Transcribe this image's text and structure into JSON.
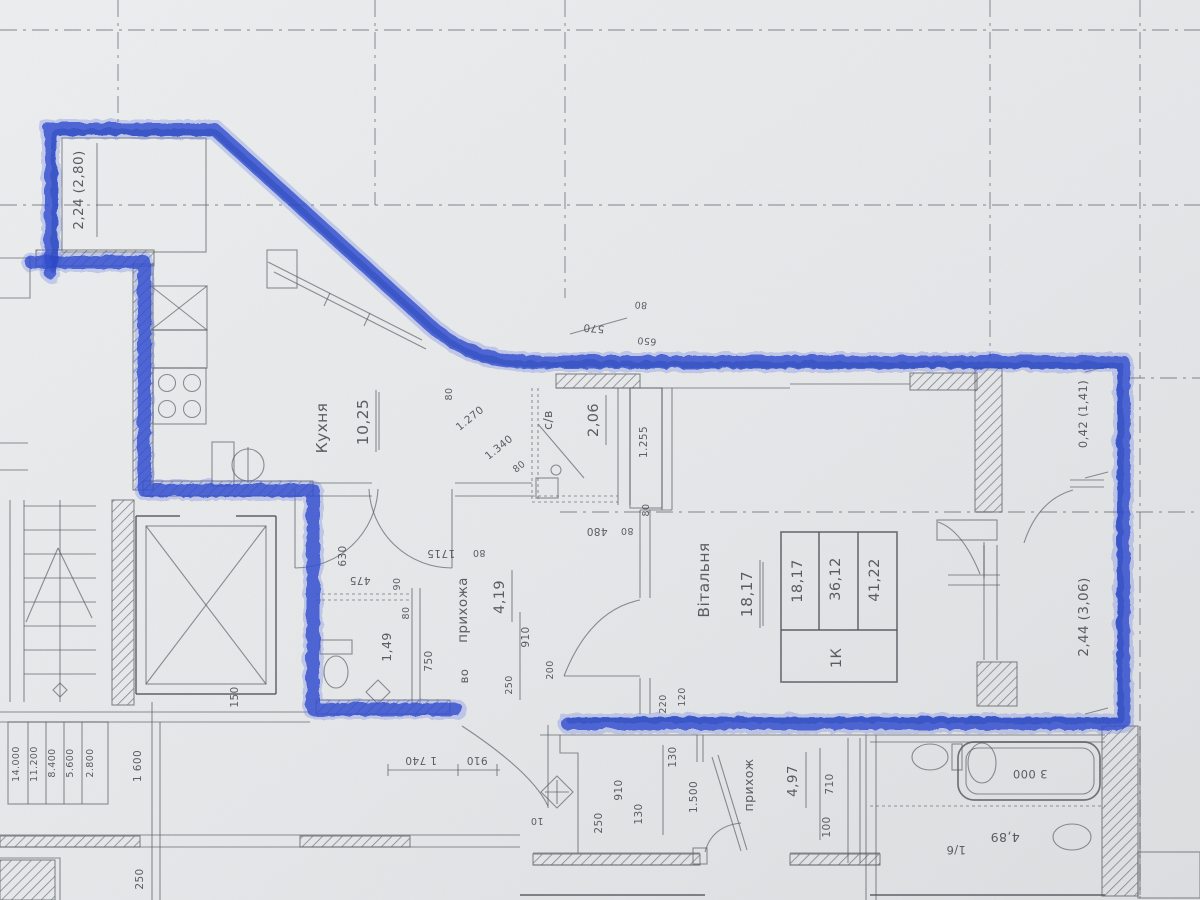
{
  "meta": {
    "title": "Scanned apartment floor plan with blue highlighter outline"
  },
  "rooms": {
    "balcony_tl": {
      "area": "2,24 (2,80)"
    },
    "kitchen": {
      "name": "Кухня",
      "area": "10,25"
    },
    "bath": {
      "name": "с/в",
      "area": "2,06"
    },
    "wc": {
      "area": "1,49"
    },
    "hallway": {
      "name": "прихожа",
      "area": "4,19",
      "extra": "во"
    },
    "living": {
      "name": "Вітальня",
      "area": "18,17"
    },
    "loggia_small": {
      "area": "0,42 (1,41)"
    },
    "loggia_right": {
      "area": "2,44 (3,06)"
    },
    "neighbor_hall": {
      "name": "прихож",
      "area": "4,97"
    },
    "neighbor_bath": {
      "area": "4,89",
      "note": "1/6",
      "tub_len": "3 000"
    }
  },
  "summary_table": {
    "unit": "1К",
    "cols": [
      "18,17",
      "36,12",
      "41,22"
    ]
  },
  "levels": [
    "14.000",
    "11.200",
    "8.400",
    "5.600",
    "2.800"
  ],
  "dims": {
    "d570": "570",
    "d650": "650",
    "d1270": "1.270",
    "d1340": "1.340",
    "d80a": "80",
    "d80b": "80",
    "d80c": "80",
    "d80d": "80",
    "d80e": "80",
    "d80f": "80",
    "d80g": "80",
    "d1255": "1.255",
    "d480": "480",
    "d1715": "1715",
    "d475": "475",
    "d630": "630",
    "d90": "90",
    "d750": "750",
    "d910a": "910",
    "d250a": "250",
    "d200": "200",
    "d220": "220",
    "d120": "120",
    "d150": "150",
    "d1600": "1 600",
    "d250corr": "250",
    "d1740": "1 740",
    "d910b": "910",
    "d10": "10",
    "d130a": "130",
    "d910c": "910",
    "d130b": "130",
    "d250b": "250",
    "d1500": "1.500",
    "d710": "710",
    "d100": "100"
  }
}
